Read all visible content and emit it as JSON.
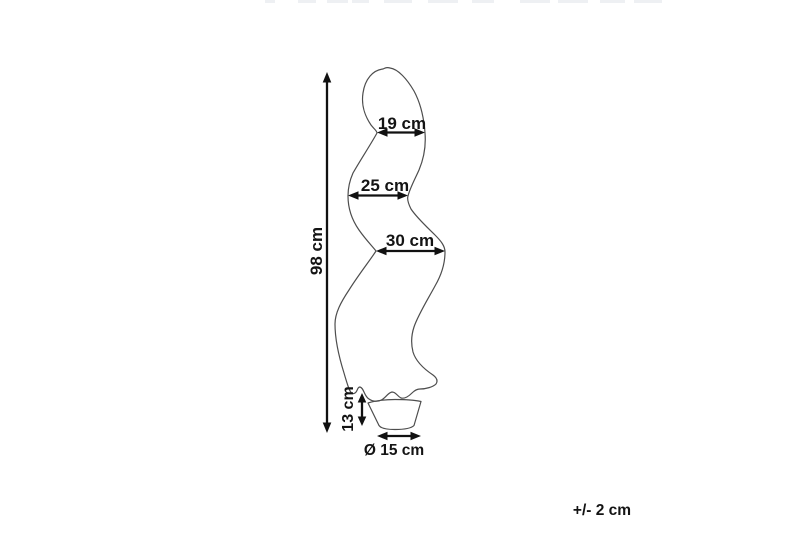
{
  "figure": {
    "dimension_labels": {
      "total_height": "98 cm",
      "top_width": "19 cm",
      "middle_width": "25 cm",
      "bottom_width": "30 cm",
      "pot_height": "13 cm",
      "pot_diameter": "Ø 15 cm"
    },
    "tolerance_note": "+/- 2 cm",
    "colors": {
      "background": "#ffffff",
      "product_outline": "#4d4d4d",
      "dimension_marks": "#111111",
      "label_text": "#141414"
    }
  }
}
